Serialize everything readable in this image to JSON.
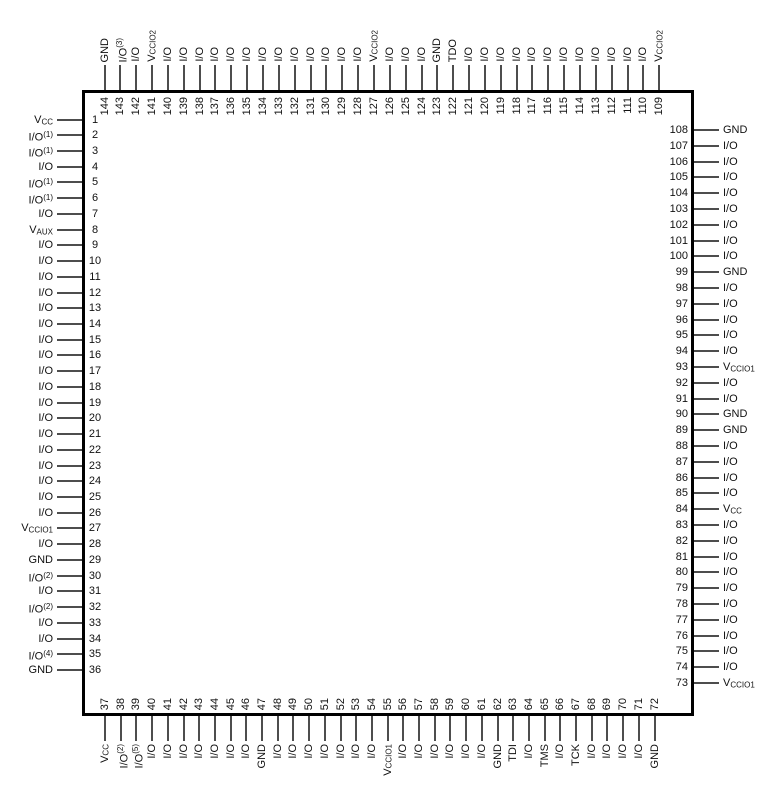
{
  "colors": {
    "background": "#ffffff",
    "chip_fill": "#ffffff",
    "chip_border": "#000000",
    "lead": "#4d4d4d",
    "text": "#111111"
  },
  "chip": {
    "pin_count": 144,
    "sides": {
      "top": [
        {
          "pin": 144,
          "label": "GND"
        },
        {
          "pin": 143,
          "label": "I/O(3)"
        },
        {
          "pin": 142,
          "label": "I/O"
        },
        {
          "pin": 141,
          "label": "VCCIO2"
        },
        {
          "pin": 140,
          "label": "I/O"
        },
        {
          "pin": 139,
          "label": "I/O"
        },
        {
          "pin": 138,
          "label": "I/O"
        },
        {
          "pin": 137,
          "label": "I/O"
        },
        {
          "pin": 136,
          "label": "I/O"
        },
        {
          "pin": 135,
          "label": "I/O"
        },
        {
          "pin": 134,
          "label": "I/O"
        },
        {
          "pin": 133,
          "label": "I/O"
        },
        {
          "pin": 132,
          "label": "I/O"
        },
        {
          "pin": 131,
          "label": "I/O"
        },
        {
          "pin": 130,
          "label": "I/O"
        },
        {
          "pin": 129,
          "label": "I/O"
        },
        {
          "pin": 128,
          "label": "I/O"
        },
        {
          "pin": 127,
          "label": "VCCIO2"
        },
        {
          "pin": 126,
          "label": "I/O"
        },
        {
          "pin": 125,
          "label": "I/O"
        },
        {
          "pin": 124,
          "label": "I/O"
        },
        {
          "pin": 123,
          "label": "GND"
        },
        {
          "pin": 122,
          "label": "TDO"
        },
        {
          "pin": 121,
          "label": "I/O"
        },
        {
          "pin": 120,
          "label": "I/O"
        },
        {
          "pin": 119,
          "label": "I/O"
        },
        {
          "pin": 118,
          "label": "I/O"
        },
        {
          "pin": 117,
          "label": "I/O"
        },
        {
          "pin": 116,
          "label": "I/O"
        },
        {
          "pin": 115,
          "label": "I/O"
        },
        {
          "pin": 114,
          "label": "I/O"
        },
        {
          "pin": 113,
          "label": "I/O"
        },
        {
          "pin": 112,
          "label": "I/O"
        },
        {
          "pin": 111,
          "label": "I/O"
        },
        {
          "pin": 110,
          "label": "I/O"
        },
        {
          "pin": 109,
          "label": "VCCIO2"
        }
      ],
      "left": [
        {
          "pin": 1,
          "label": "VCC"
        },
        {
          "pin": 2,
          "label": "I/O(1)"
        },
        {
          "pin": 3,
          "label": "I/O(1)"
        },
        {
          "pin": 4,
          "label": "I/O"
        },
        {
          "pin": 5,
          "label": "I/O(1)"
        },
        {
          "pin": 6,
          "label": "I/O(1)"
        },
        {
          "pin": 7,
          "label": "I/O"
        },
        {
          "pin": 8,
          "label": "VAUX"
        },
        {
          "pin": 9,
          "label": "I/O"
        },
        {
          "pin": 10,
          "label": "I/O"
        },
        {
          "pin": 11,
          "label": "I/O"
        },
        {
          "pin": 12,
          "label": "I/O"
        },
        {
          "pin": 13,
          "label": "I/O"
        },
        {
          "pin": 14,
          "label": "I/O"
        },
        {
          "pin": 15,
          "label": "I/O"
        },
        {
          "pin": 16,
          "label": "I/O"
        },
        {
          "pin": 17,
          "label": "I/O"
        },
        {
          "pin": 18,
          "label": "I/O"
        },
        {
          "pin": 19,
          "label": "I/O"
        },
        {
          "pin": 20,
          "label": "I/O"
        },
        {
          "pin": 21,
          "label": "I/O"
        },
        {
          "pin": 22,
          "label": "I/O"
        },
        {
          "pin": 23,
          "label": "I/O"
        },
        {
          "pin": 24,
          "label": "I/O"
        },
        {
          "pin": 25,
          "label": "I/O"
        },
        {
          "pin": 26,
          "label": "I/O"
        },
        {
          "pin": 27,
          "label": "VCCIO1"
        },
        {
          "pin": 28,
          "label": "I/O"
        },
        {
          "pin": 29,
          "label": "GND"
        },
        {
          "pin": 30,
          "label": "I/O(2)"
        },
        {
          "pin": 31,
          "label": "I/O"
        },
        {
          "pin": 32,
          "label": "I/O(2)"
        },
        {
          "pin": 33,
          "label": "I/O"
        },
        {
          "pin": 34,
          "label": "I/O"
        },
        {
          "pin": 35,
          "label": "I/O(4)"
        },
        {
          "pin": 36,
          "label": "GND"
        }
      ],
      "right": [
        {
          "pin": 108,
          "label": "GND"
        },
        {
          "pin": 107,
          "label": "I/O"
        },
        {
          "pin": 106,
          "label": "I/O"
        },
        {
          "pin": 105,
          "label": "I/O"
        },
        {
          "pin": 104,
          "label": "I/O"
        },
        {
          "pin": 103,
          "label": "I/O"
        },
        {
          "pin": 102,
          "label": "I/O"
        },
        {
          "pin": 101,
          "label": "I/O"
        },
        {
          "pin": 100,
          "label": "I/O"
        },
        {
          "pin": 99,
          "label": "GND"
        },
        {
          "pin": 98,
          "label": "I/O"
        },
        {
          "pin": 97,
          "label": "I/O"
        },
        {
          "pin": 96,
          "label": "I/O"
        },
        {
          "pin": 95,
          "label": "I/O"
        },
        {
          "pin": 94,
          "label": "I/O"
        },
        {
          "pin": 93,
          "label": "VCCIO1"
        },
        {
          "pin": 92,
          "label": "I/O"
        },
        {
          "pin": 91,
          "label": "I/O"
        },
        {
          "pin": 90,
          "label": "GND"
        },
        {
          "pin": 89,
          "label": "GND"
        },
        {
          "pin": 88,
          "label": "I/O"
        },
        {
          "pin": 87,
          "label": "I/O"
        },
        {
          "pin": 86,
          "label": "I/O"
        },
        {
          "pin": 85,
          "label": "I/O"
        },
        {
          "pin": 84,
          "label": "VCC"
        },
        {
          "pin": 83,
          "label": "I/O"
        },
        {
          "pin": 82,
          "label": "I/O"
        },
        {
          "pin": 81,
          "label": "I/O"
        },
        {
          "pin": 80,
          "label": "I/O"
        },
        {
          "pin": 79,
          "label": "I/O"
        },
        {
          "pin": 78,
          "label": "I/O"
        },
        {
          "pin": 77,
          "label": "I/O"
        },
        {
          "pin": 76,
          "label": "I/O"
        },
        {
          "pin": 75,
          "label": "I/O"
        },
        {
          "pin": 74,
          "label": "I/O"
        },
        {
          "pin": 73,
          "label": "VCCIO1"
        }
      ],
      "bottom": [
        {
          "pin": 37,
          "label": "VCC"
        },
        {
          "pin": 38,
          "label": "I/O(2)"
        },
        {
          "pin": 39,
          "label": "I/O(5)"
        },
        {
          "pin": 40,
          "label": "I/O"
        },
        {
          "pin": 41,
          "label": "I/O"
        },
        {
          "pin": 42,
          "label": "I/O"
        },
        {
          "pin": 43,
          "label": "I/O"
        },
        {
          "pin": 44,
          "label": "I/O"
        },
        {
          "pin": 45,
          "label": "I/O"
        },
        {
          "pin": 46,
          "label": "I/O"
        },
        {
          "pin": 47,
          "label": "GND"
        },
        {
          "pin": 48,
          "label": "I/O"
        },
        {
          "pin": 49,
          "label": "I/O"
        },
        {
          "pin": 50,
          "label": "I/O"
        },
        {
          "pin": 51,
          "label": "I/O"
        },
        {
          "pin": 52,
          "label": "I/O"
        },
        {
          "pin": 53,
          "label": "I/O"
        },
        {
          "pin": 54,
          "label": "I/O"
        },
        {
          "pin": 55,
          "label": "VCCIO1"
        },
        {
          "pin": 56,
          "label": "I/O"
        },
        {
          "pin": 57,
          "label": "I/O"
        },
        {
          "pin": 58,
          "label": "I/O"
        },
        {
          "pin": 59,
          "label": "I/O"
        },
        {
          "pin": 60,
          "label": "I/O"
        },
        {
          "pin": 61,
          "label": "I/O"
        },
        {
          "pin": 62,
          "label": "GND"
        },
        {
          "pin": 63,
          "label": "TDI"
        },
        {
          "pin": 64,
          "label": "I/O"
        },
        {
          "pin": 65,
          "label": "TMS"
        },
        {
          "pin": 66,
          "label": "I/O"
        },
        {
          "pin": 67,
          "label": "TCK"
        },
        {
          "pin": 68,
          "label": "I/O"
        },
        {
          "pin": 69,
          "label": "I/O"
        },
        {
          "pin": 70,
          "label": "I/O"
        },
        {
          "pin": 71,
          "label": "I/O"
        },
        {
          "pin": 72,
          "label": "GND"
        }
      ]
    }
  }
}
